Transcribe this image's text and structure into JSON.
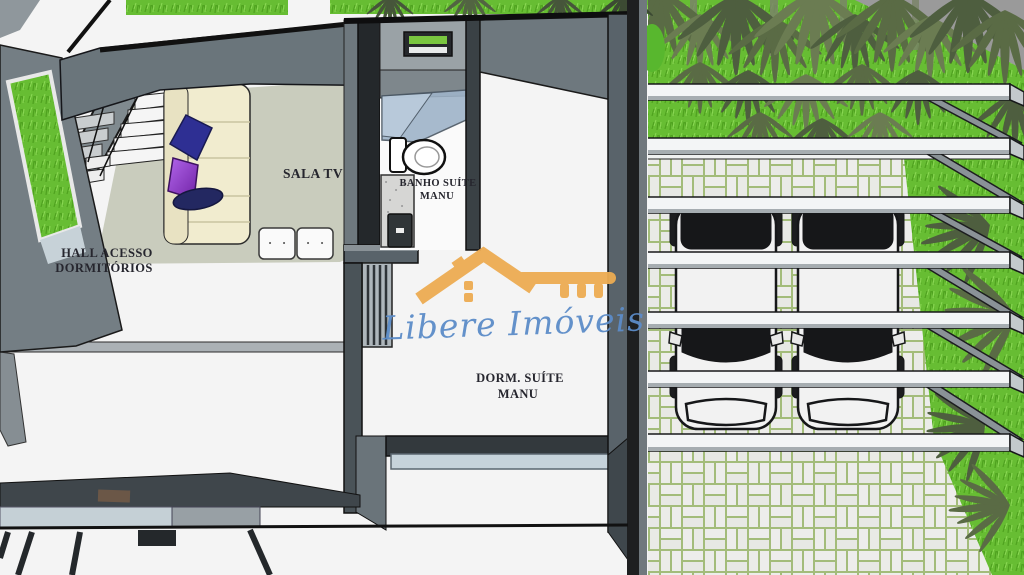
{
  "scene": {
    "rooms": {
      "sala_tv": {
        "label": "SALA TV"
      },
      "hall": {
        "line1": "HALL ACESSO",
        "line2": "DORMITÓRIOS"
      },
      "banho": {
        "line1": "BANHO SUÍTE",
        "line2": "MANU"
      },
      "dorm": {
        "line1": "DORM. SUÍTE",
        "line2": "MANU"
      }
    },
    "watermark": {
      "brand": "Libere Imóveis",
      "icon": "house-key-logo",
      "icon_color": "#EDAC52",
      "text_color": "#5C8CC8"
    },
    "palette": {
      "wall_dark": "#2E3337",
      "wall_mid": "#59636A",
      "wall_light": "#8A9297",
      "floor_sala": "#C9CCBD",
      "floor_white": "#F4F4F4",
      "sofa_cream": "#F1ECCF",
      "pillow_navy": "#2E2F93",
      "pillow_purple": "#A34FE0",
      "grass_green": "#67BD33",
      "palm_green": "#5A6B45",
      "pavement_brick": "#EDEDEB",
      "pavement_grout": "#A3BC7A",
      "beam_white": "#F3F5F6",
      "glass_blue": "#C6D3DB",
      "sky_gray": "#9A9A9A",
      "car_black": "#161719",
      "car_white": "#F2F2F2"
    }
  }
}
